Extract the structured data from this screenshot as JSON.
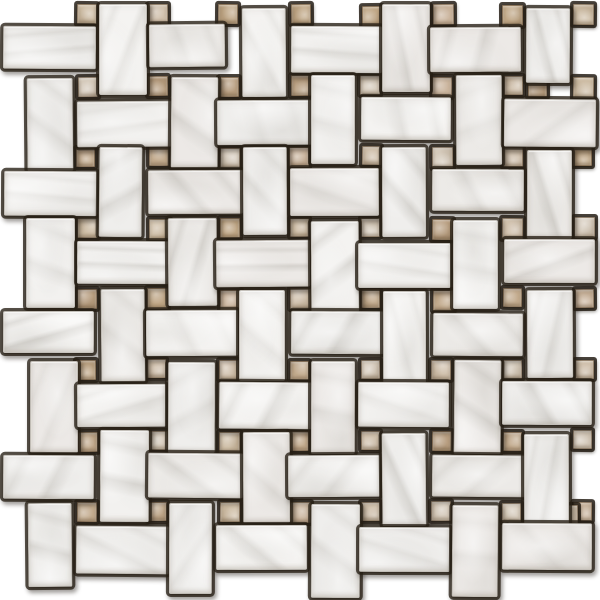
{
  "image": {
    "description": "White marble basketweave mosaic tile sheet with beige square dots and dark grout joints on a white background",
    "width": 600,
    "height": 600,
    "background": "#ffffff"
  },
  "pattern": {
    "type": "basketweave-with-dot",
    "pitch": 71,
    "origin_x": 6,
    "origin_y": 5,
    "corridor_cols": 8,
    "corridor_rows": 8,
    "h_tile": {
      "w": 92,
      "h": 45,
      "off_x": -1,
      "off_y": 23
    },
    "v_tile": {
      "w": 46,
      "h": 91,
      "off_x": 22,
      "off_y": 1
    },
    "dot": {
      "size": 20,
      "col_start": 1,
      "col_end": 8,
      "row_start": 0,
      "row_end": 7
    },
    "seed": 11,
    "jitter": {
      "pos": 2.4,
      "size": 3.2,
      "rot": 0.55
    },
    "marble_base_colors": [
      "#f2f1ef",
      "#efeeec",
      "#ece9e6",
      "#f4f3f1",
      "#eceae7"
    ],
    "marble_vein_color": "166,162,154",
    "marble_cloud_color": "186,183,176",
    "dot_colors": [
      "#d5cabb",
      "#cdbca4",
      "#c3ab8e",
      "#b79d7f",
      "#d0c0ac",
      "#bfa685",
      "#cbb59e"
    ],
    "grout_color": "rgba(40,32,22,0.78)",
    "extra_dots": [
      {
        "x": 527,
        "y": 77
      },
      {
        "x": 556,
        "y": 505
      }
    ],
    "overrides": [
      {
        "kind": "v",
        "i": 7,
        "j": 0,
        "dh": -16
      },
      {
        "kind": "h",
        "i": 2,
        "j": 0,
        "dw": -13,
        "dy": -5
      },
      {
        "kind": "v",
        "i": 0,
        "j": 7,
        "dh": -8
      },
      {
        "kind": "v",
        "i": 4,
        "j": 7,
        "dh": 4
      },
      {
        "kind": "v",
        "i": 6,
        "j": 7,
        "dh": 4
      },
      {
        "kind": "h",
        "i": 0,
        "j": 0,
        "dy": -3
      },
      {
        "kind": "v",
        "i": 2,
        "j": 7,
        "dh": 2
      }
    ]
  }
}
